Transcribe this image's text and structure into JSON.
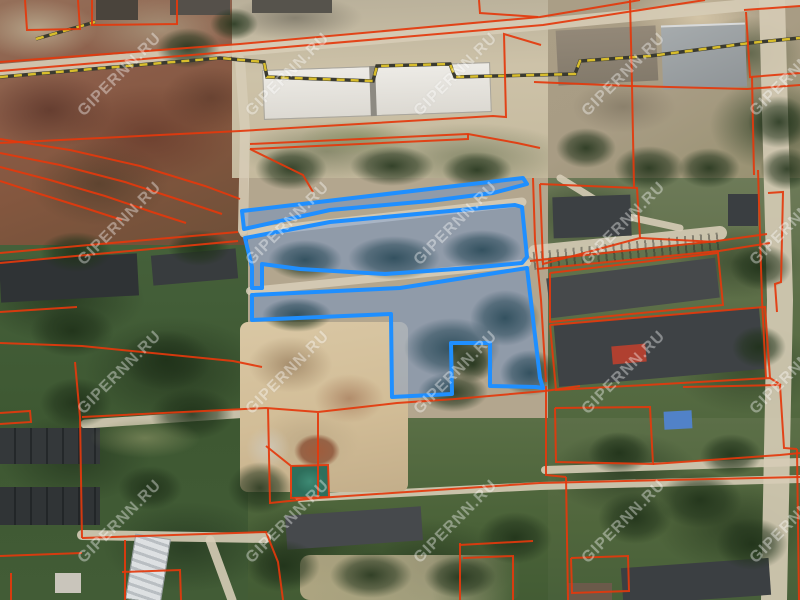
{
  "map": {
    "watermark": {
      "text": "GIPERNN.RU",
      "color": "#ffffff",
      "opacity": 0.38,
      "rotation_deg": -45,
      "grid_x": [
        120,
        288,
        456,
        624,
        792
      ],
      "grid_y": [
        75,
        224,
        373,
        522
      ]
    },
    "selection": {
      "stroke": "#1f8fff",
      "fill": "rgba(50,125,245,0.27)",
      "stroke_width": 4,
      "parcels": [
        [
          [
            242,
            211
          ],
          [
            523,
            178
          ],
          [
            527,
            184
          ],
          [
            493,
            193
          ],
          [
            430,
            201
          ],
          [
            330,
            210
          ],
          [
            244,
            229
          ]
        ],
        [
          [
            245,
            238
          ],
          [
            330,
            222
          ],
          [
            515,
            205
          ],
          [
            522,
            207
          ],
          [
            527,
            257
          ],
          [
            522,
            263
          ],
          [
            470,
            268
          ],
          [
            385,
            274
          ],
          [
            300,
            269
          ],
          [
            262,
            264
          ],
          [
            262,
            288
          ],
          [
            252,
            288
          ],
          [
            252,
            267
          ]
        ],
        [
          [
            252,
            295
          ],
          [
            400,
            288
          ],
          [
            527,
            268
          ],
          [
            540,
            378
          ],
          [
            543,
            388
          ],
          [
            536,
            387
          ],
          [
            490,
            386
          ],
          [
            490,
            343
          ],
          [
            451,
            343
          ],
          [
            452,
            394
          ],
          [
            392,
            397
          ],
          [
            391,
            314
          ],
          [
            252,
            320
          ]
        ]
      ]
    },
    "cadastral": {
      "stroke": "#e4380c",
      "stroke_width": 2,
      "lines": [
        [
          [
            0,
            62
          ],
          [
            240,
            44
          ],
          [
            540,
            17
          ],
          [
            640,
            0
          ]
        ],
        [
          [
            0,
            71
          ],
          [
            240,
            51
          ],
          [
            543,
            25
          ],
          [
            705,
            0
          ]
        ],
        [
          [
            479,
            0
          ],
          [
            480,
            13
          ],
          [
            538,
            17
          ]
        ],
        [
          [
            0,
            143
          ],
          [
            240,
            131
          ],
          [
            493,
            116
          ],
          [
            506,
            117
          ],
          [
            504,
            34
          ],
          [
            541,
            45
          ]
        ],
        [
          [
            250,
            144
          ],
          [
            468,
            134
          ],
          [
            517,
            143
          ],
          [
            540,
            148
          ]
        ],
        [
          [
            250,
            149
          ],
          [
            468,
            139
          ],
          [
            468,
            134
          ]
        ],
        [
          [
            250,
            149
          ],
          [
            303,
            175
          ],
          [
            313,
            192
          ]
        ],
        [
          [
            0,
            139
          ],
          [
            70,
            150
          ],
          [
            140,
            166
          ],
          [
            205,
            186
          ],
          [
            240,
            199
          ]
        ],
        [
          [
            0,
            153
          ],
          [
            60,
            165
          ],
          [
            125,
            182
          ],
          [
            180,
            200
          ],
          [
            222,
            214
          ]
        ],
        [
          [
            0,
            167
          ],
          [
            50,
            180
          ],
          [
            105,
            196
          ],
          [
            152,
            212
          ],
          [
            186,
            223
          ]
        ],
        [
          [
            0,
            181
          ],
          [
            40,
            194
          ],
          [
            85,
            208
          ],
          [
            122,
            220
          ]
        ],
        [
          [
            25,
            0
          ],
          [
            27,
            30
          ],
          [
            80,
            29
          ],
          [
            78,
            0
          ]
        ],
        [
          [
            92,
            0
          ],
          [
            92,
            25
          ],
          [
            177,
            24
          ],
          [
            177,
            0
          ]
        ],
        [
          [
            0,
            253
          ],
          [
            100,
            244
          ],
          [
            238,
            232
          ]
        ],
        [
          [
            0,
            263
          ],
          [
            238,
            241
          ]
        ],
        [
          [
            0,
            312
          ],
          [
            77,
            307
          ]
        ],
        [
          [
            0,
            343
          ],
          [
            82,
            346
          ],
          [
            233,
            361
          ],
          [
            262,
            367
          ]
        ],
        [
          [
            75,
            362
          ],
          [
            80,
            417
          ],
          [
            82,
            538
          ]
        ],
        [
          [
            0,
            413
          ],
          [
            30,
            411
          ],
          [
            31,
            422
          ],
          [
            0,
            424
          ]
        ],
        [
          [
            82,
            417
          ],
          [
            266,
            408
          ],
          [
            318,
            412
          ],
          [
            397,
            403
          ],
          [
            455,
            399
          ],
          [
            545,
            391
          ],
          [
            580,
            386
          ]
        ],
        [
          [
            318,
            413
          ],
          [
            318,
            498
          ]
        ],
        [
          [
            268,
            408
          ],
          [
            270,
            503
          ],
          [
            318,
            498
          ],
          [
            540,
            483
          ],
          [
            800,
            477
          ]
        ],
        [
          [
            291,
            466
          ],
          [
            328,
            465
          ],
          [
            329,
            497
          ],
          [
            291,
            498
          ],
          [
            291,
            466
          ],
          [
            266,
            446
          ]
        ],
        [
          [
            82,
            538
          ],
          [
            266,
            532
          ],
          [
            278,
            562
          ],
          [
            283,
            600
          ]
        ],
        [
          [
            0,
            556
          ],
          [
            82,
            553
          ]
        ],
        [
          [
            11,
            573
          ],
          [
            11,
            600
          ]
        ],
        [
          [
            125,
            540
          ],
          [
            125,
            600
          ]
        ],
        [
          [
            122,
            572
          ],
          [
            180,
            570
          ],
          [
            181,
            600
          ]
        ],
        [
          [
            460,
            543
          ],
          [
            460,
            600
          ]
        ],
        [
          [
            459,
            545
          ],
          [
            533,
            541
          ]
        ],
        [
          [
            463,
            558
          ],
          [
            513,
            556
          ],
          [
            513,
            600
          ]
        ],
        [
          [
            546,
            386
          ],
          [
            546,
            475
          ],
          [
            566,
            477
          ]
        ],
        [
          [
            566,
            477
          ],
          [
            568,
            600
          ]
        ],
        [
          [
            571,
            558
          ],
          [
            628,
            556
          ],
          [
            629,
            591
          ],
          [
            572,
            593
          ],
          [
            571,
            558
          ]
        ],
        [
          [
            533,
            178
          ],
          [
            535,
            240
          ],
          [
            541,
            300
          ],
          [
            546,
            382
          ]
        ],
        [
          [
            540,
            184
          ],
          [
            637,
            188
          ],
          [
            640,
            238
          ],
          [
            543,
            264
          ],
          [
            540,
            184
          ]
        ],
        [
          [
            640,
            238
          ],
          [
            716,
            242
          ]
        ],
        [
          [
            530,
            261
          ],
          [
            717,
            241
          ],
          [
            767,
            234
          ]
        ],
        [
          [
            537,
            269
          ],
          [
            719,
            251
          ],
          [
            770,
            243
          ]
        ],
        [
          [
            550,
            273
          ],
          [
            718,
            253
          ],
          [
            723,
            305
          ],
          [
            550,
            322
          ],
          [
            550,
            273
          ]
        ],
        [
          [
            550,
            325
          ],
          [
            765,
            307
          ],
          [
            770,
            378
          ],
          [
            556,
            390
          ],
          [
            550,
            325
          ]
        ],
        [
          [
            555,
            408
          ],
          [
            650,
            407
          ],
          [
            653,
            464
          ],
          [
            556,
            462
          ],
          [
            555,
            408
          ]
        ],
        [
          [
            653,
            464
          ],
          [
            780,
            455
          ],
          [
            800,
            453
          ]
        ],
        [
          [
            683,
            387
          ],
          [
            780,
            385
          ],
          [
            784,
            448
          ],
          [
            797,
            449
          ]
        ],
        [
          [
            770,
            378
          ],
          [
            781,
            385
          ]
        ],
        [
          [
            797,
            449
          ],
          [
            799,
            600
          ]
        ],
        [
          [
            746,
            12
          ],
          [
            750,
            77
          ],
          [
            800,
            73
          ]
        ],
        [
          [
            744,
            10
          ],
          [
            800,
            6
          ]
        ],
        [
          [
            630,
            0
          ],
          [
            632,
            85
          ],
          [
            634,
            187
          ]
        ],
        [
          [
            534,
            82
          ],
          [
            630,
            86
          ],
          [
            747,
            89
          ],
          [
            800,
            85
          ]
        ],
        [
          [
            752,
            77
          ],
          [
            754,
            175
          ]
        ],
        [
          [
            758,
            170
          ],
          [
            762,
            300
          ],
          [
            766,
            378
          ]
        ],
        [
          [
            768,
            193
          ],
          [
            783,
            192
          ],
          [
            781,
            282
          ],
          [
            775,
            284
          ],
          [
            777,
            312
          ]
        ]
      ]
    },
    "pipeline": {
      "stroke": "#d8bd2c",
      "underlay": "#3a3a30",
      "dash": "8 6",
      "lines": [
        [
          [
            0,
            77
          ],
          [
            150,
            64
          ],
          [
            220,
            58
          ],
          [
            264,
            62
          ],
          [
            267,
            77
          ],
          [
            373,
            81
          ],
          [
            377,
            66
          ],
          [
            450,
            64
          ],
          [
            455,
            77
          ],
          [
            575,
            74
          ],
          [
            580,
            61
          ],
          [
            650,
            56
          ],
          [
            750,
            43
          ],
          [
            800,
            38
          ]
        ],
        [
          [
            36,
            39
          ],
          [
            95,
            22
          ]
        ]
      ]
    },
    "roads": {
      "color": "#d6ccb6",
      "paths": [
        {
          "w": 12,
          "pts": [
            [
              0,
              70
            ],
            [
              240,
              50
            ],
            [
              543,
              24
            ],
            [
              800,
              0
            ]
          ]
        },
        {
          "w": 9,
          "pts": [
            [
              244,
              233
            ],
            [
              522,
              202
            ]
          ]
        },
        {
          "w": 8,
          "pts": [
            [
              250,
              291
            ],
            [
              527,
              263
            ]
          ]
        },
        {
          "w": 9,
          "pts": [
            [
              85,
              424
            ],
            [
              265,
              412
            ]
          ]
        },
        {
          "w": 8,
          "pts": [
            [
              268,
              410
            ],
            [
              277,
              470
            ],
            [
              300,
              498
            ],
            [
              420,
              492
            ],
            [
              540,
              486
            ],
            [
              800,
              479
            ]
          ]
        },
        {
          "w": 10,
          "pts": [
            [
              240,
              60
            ],
            [
              245,
              130
            ],
            [
              243,
              230
            ]
          ]
        },
        {
          "w": 26,
          "pts": [
            [
              772,
              0
            ],
            [
              780,
              300
            ],
            [
              774,
              600
            ]
          ]
        },
        {
          "w": 10,
          "pts": [
            [
              82,
              535
            ],
            [
              266,
              538
            ]
          ]
        },
        {
          "w": 9,
          "pts": [
            [
              210,
              540
            ],
            [
              232,
              600
            ]
          ]
        },
        {
          "w": 14,
          "pts": [
            [
              535,
              252
            ],
            [
              720,
              233
            ]
          ]
        },
        {
          "w": 8,
          "pts": [
            [
              545,
              470
            ],
            [
              800,
              462
            ]
          ]
        },
        {
          "w": 7,
          "pts": [
            [
              560,
              178
            ],
            [
              620,
              215
            ],
            [
              680,
              228
            ]
          ]
        }
      ]
    },
    "railway": {
      "color": "#b5aea0",
      "tie_color": "rgba(45,45,40,0.5)"
    }
  }
}
